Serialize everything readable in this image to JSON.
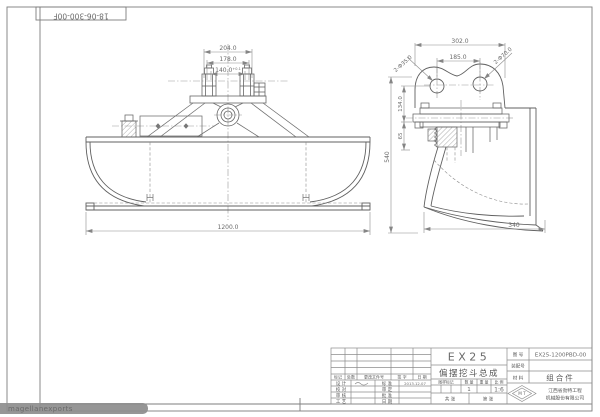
{
  "sheet": {
    "doc_code": "18-06-300-00F",
    "watermark": "magellanexports"
  },
  "front_view": {
    "dim_width_outer": "204.0",
    "dim_width_mid": "178.0",
    "dim_width_inner": "140.0",
    "dim_width_inner_tol": "+0.1",
    "dim_overall_width": "1200.0"
  },
  "side_view": {
    "dim_plate_width": "302.0",
    "dim_hole_spacing": "185.0",
    "dim_boss": "2-Φ70.0",
    "dim_holes": "2-Φ35.0",
    "dim_plate_height": "134.0",
    "dim_mount_height": "65",
    "dim_overall_height": "540",
    "dim_bottom_width": "340"
  },
  "title_block": {
    "model": "EX25",
    "drawing_title": "偏摆挖斗总成",
    "rev_headers": [
      "标记",
      "处数",
      "更改文件号",
      "签 字",
      "日 期"
    ],
    "sign_rows": [
      {
        "role": "设 计",
        "role2": "标 准",
        "date": "2013.12.07"
      },
      {
        "role": "校 对",
        "role2": "审 定",
        "date": ""
      },
      {
        "role": "审 核",
        "role2": "批 准",
        "date": ""
      },
      {
        "role": "工 艺",
        "role2": "日 期",
        "date": ""
      }
    ],
    "spec": {
      "headers": [
        "图样标记",
        "数 量",
        "重 量",
        "比 例"
      ],
      "quantity": "1",
      "weight": "",
      "scale": "1:6",
      "sheets_total": "共  张",
      "sheet_no": "第  张"
    },
    "info": {
      "drawing_no_label": "图 号",
      "drawing_no": "EX25-1200PBD-00",
      "assembly_no_label": "装配号",
      "material_label": "材 料",
      "material": "组合件",
      "company_line1": "江西省劲特工程",
      "company_line2": "机械股份有限公司",
      "logo_text": "M T"
    }
  }
}
